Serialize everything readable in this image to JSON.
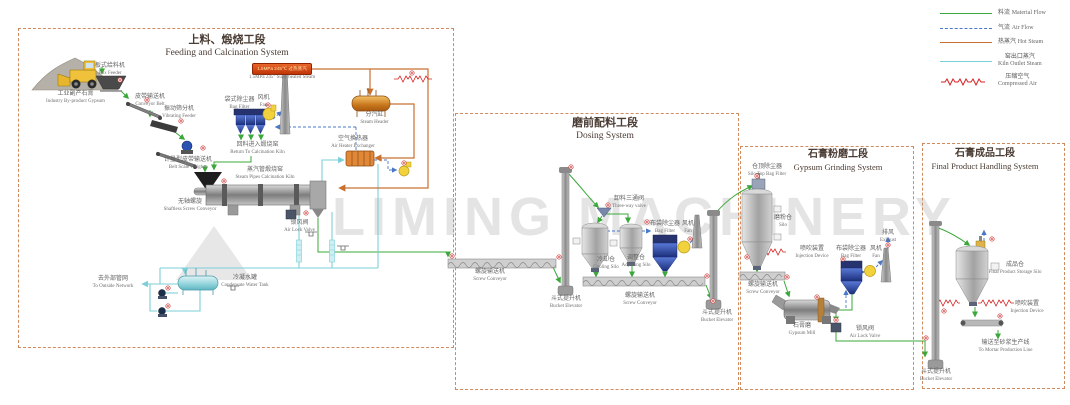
{
  "watermark": "LIMING MACHINERY",
  "legend": {
    "items": [
      {
        "cn": "料流",
        "en": "Material Flow",
        "color": "#3aa83a",
        "style": "solid"
      },
      {
        "cn": "气流",
        "en": "Air Flow",
        "color": "#4878c8",
        "style": "dashed"
      },
      {
        "cn": "热蒸汽",
        "en": "Hot Steam",
        "color": "#c87030",
        "style": "solid"
      },
      {
        "cn": "窑出口蒸汽",
        "en": "Kiln Outlet Steam",
        "color": "#7ccfd8",
        "style": "solid"
      },
      {
        "cn": "压缩空气",
        "en": "Compressed Air",
        "color": "#d42020",
        "style": "zigzag"
      }
    ]
  },
  "sections": [
    {
      "title_cn": "上料、煅烧工段",
      "title_en": "Feeding and Calcination System",
      "labels": {
        "industry_gypsum": {
          "cn": "工业副产石膏",
          "en": "Industry By-product Gypsum"
        },
        "box_feeder": {
          "cn": "板式给料机",
          "en": "Box Feeder"
        },
        "conveyor_belt": {
          "cn": "皮带输送机",
          "en": "Conveyor Belt"
        },
        "vibrating_feeder": {
          "cn": "振动筛分机",
          "en": "Vibrating Feeder"
        },
        "belt_scale": {
          "cn": "计量型皮带输送机",
          "en": "Belt Scale Weigher"
        },
        "bag_filter": {
          "cn": "袋式除尘器",
          "en": "Bag Filter"
        },
        "fan": {
          "cn": "风机",
          "en": "Fan"
        },
        "return_kiln": {
          "cn": "回料进入煅烧窑",
          "en": "Return To Calcination Kiln"
        },
        "banner": {
          "cn": "1.5MPa 245℃ 过热蒸汽",
          "en": "1.5MPa 245° Superheated Steam"
        },
        "steam_header": {
          "cn": "分汽缸",
          "en": "Steam Header"
        },
        "air_heater": {
          "cn": "空气换热器",
          "en": "Air Heater Exchanger"
        },
        "kiln": {
          "cn": "蒸汽管煅烧窑",
          "en": "Steam Pipes Calcination Kiln"
        },
        "shaftless_screw": {
          "cn": "无轴螺旋",
          "en": "Shaftless Screw Conveyor"
        },
        "air_lock": {
          "cn": "锁风阀",
          "en": "Air Lock Valve"
        },
        "condensate_tank": {
          "cn": "冷凝水罐",
          "en": "Condensate Water Tank"
        },
        "outside_network": {
          "cn": "去外部管网",
          "en": "To Outside Network"
        }
      }
    },
    {
      "title_cn": "磨前配料工段",
      "title_en": "Dosing System",
      "labels": {
        "screw_conveyor_1": {
          "cn": "螺旋输送机",
          "en": "Screw Conveyor"
        },
        "bucket_elevator_1": {
          "cn": "斗式提升机",
          "en": "Bucket Elevator"
        },
        "three_way_valve": {
          "cn": "卸料三通阀",
          "en": "Three-way valve"
        },
        "cooling_silo": {
          "cn": "冷却仓",
          "en": "Cooling Silo"
        },
        "adjusting_silo": {
          "cn": "调整仓",
          "en": "Adjusting Silo"
        },
        "bag_filter": {
          "cn": "布袋除尘器",
          "en": "Bag Filter"
        },
        "fan": {
          "cn": "风机",
          "en": "Fan"
        },
        "screw_conveyor_2": {
          "cn": "螺旋输送机",
          "en": "Screw Conveyor"
        },
        "bucket_elevator_2": {
          "cn": "斗式提升机",
          "en": "Bucket Elevator"
        }
      }
    },
    {
      "title_cn": "石膏粉磨工段",
      "title_en": "Gypsum Grinding System",
      "labels": {
        "silo_top_bag_filter": {
          "cn": "仓顶除尘器",
          "en": "Silo Top Bag Filter"
        },
        "silo": {
          "cn": "磨粉仓",
          "en": "Silo"
        },
        "injection_device": {
          "cn": "喷吹装置",
          "en": "Injection Device"
        },
        "screw_conveyor": {
          "cn": "螺旋输送机",
          "en": "Screw Conveyor"
        },
        "gypsum_mill": {
          "cn": "石膏磨",
          "en": "Gypsum Mill"
        },
        "bag_filter": {
          "cn": "布袋除尘器",
          "en": "Bag Filter"
        },
        "fan": {
          "cn": "风机",
          "en": "Fan"
        },
        "exhaust": {
          "cn": "排风",
          "en": "Exhaust"
        },
        "air_lock": {
          "cn": "锁风阀",
          "en": "Air Lock Valve"
        }
      }
    },
    {
      "title_cn": "石膏成品工段",
      "title_en": "Final Product Handling System",
      "labels": {
        "product_silo": {
          "cn": "成品仓",
          "en": "Final Product Storage Silo"
        },
        "injection_device": {
          "cn": "喷吹装置",
          "en": "Injection Device"
        },
        "to_mortar": {
          "cn": "输送至砂浆生产线",
          "en": "To Mortar Production Line"
        },
        "bucket_elevator": {
          "cn": "斗式提升机",
          "en": "Bucket Elevator"
        }
      }
    }
  ]
}
